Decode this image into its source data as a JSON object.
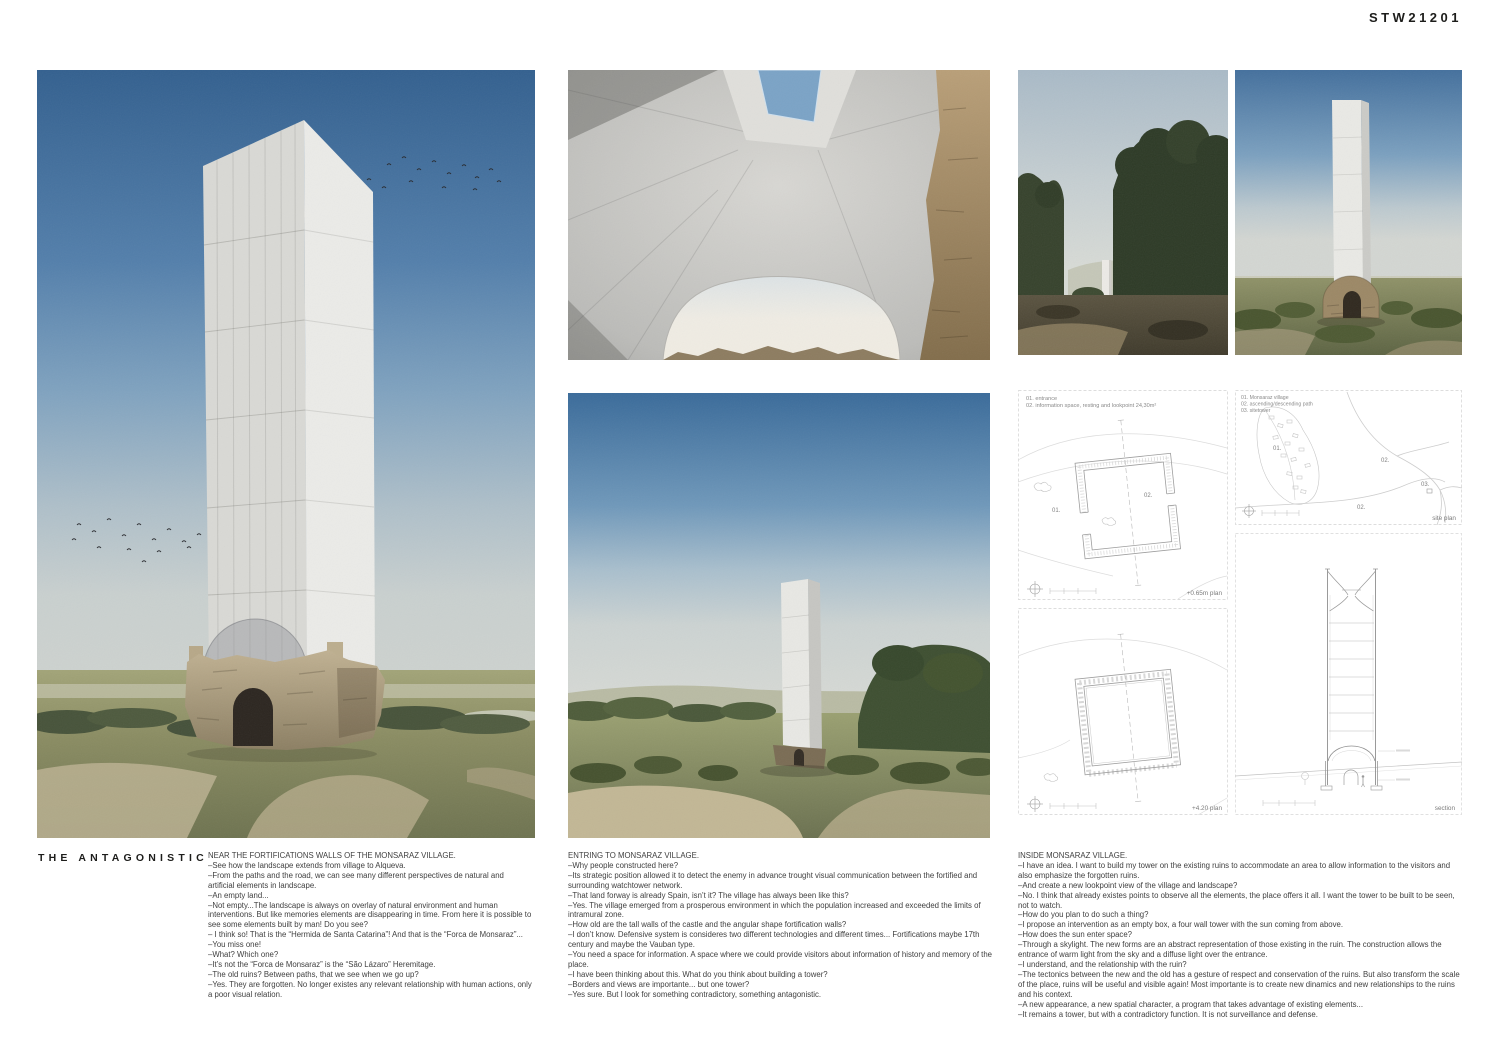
{
  "board": {
    "code": "STW21201",
    "title": "THE ANTAGONISTIC"
  },
  "colors": {
    "sky_deep": "#33608f",
    "sky_pale": "#ccd4d4",
    "concrete": "#e3e3e1",
    "ruin_stone": "#b3a387",
    "landscape_olive": "#6f7350",
    "drawing_line": "#9e9e9e"
  },
  "columns": [
    {
      "heading": "NEAR THE FORTIFICATIONS WALLS OF THE MONSARAZ VILLAGE.",
      "lines": [
        "–See how the landscape extends from village to Alqueva.",
        "–From the paths and the road, we can see many different perspectives de natural and artificial elements in landscape.",
        "–An empty land...",
        "–Not empty...The landscape is always on overlay of natural environment and human interventions. But like memories elements are disappearing in time. From here it is possible to see some elements built by man! Do you see?",
        "– I think so! That is the “Hermida de Santa Catarina”! And that is the “Forca de Monsaraz”...",
        "–You miss one!",
        "–What? Which one?",
        "–It’s not the “Forca de Monsaraz” is the “São Lázaro” Heremitage.",
        "–The old ruins? Between paths, that we see when we go up?",
        "–Yes. They are forgotten. No longer existes any relevant relationship with human actions, only a poor visual relation."
      ]
    },
    {
      "heading": "ENTRING TO MONSARAZ VILLAGE.",
      "lines": [
        "–Why people constructed here?",
        "–Its strategic position allowed it to detect the enemy in advance trought visual communication between the fortified and surrounding watchtower network.",
        "–That land forway is already Spain, isn’t it? The village has always been like this?",
        "–Yes. The village emerged from a prosperous environment in which the population increased and exceeded the limits of intramural zone.",
        "–How old are the tall walls of the castle and the angular shape fortification walls?",
        "–I don’t know. Defensive system is consideres two different technologies and different times... Fortifications maybe 17th century  and maybe the Vauban type.",
        "–You need a space for information. A space where we could provide visitors about information of history and memory of the place.",
        "–I have been thinking about this. What do you think about building a tower?",
        "–Borders and views are importante... but one tower?",
        "–Yes sure. But I look for something contradictory, something antagonistic."
      ]
    },
    {
      "heading": "INSIDE MONSARAZ VILLAGE.",
      "lines": [
        "–I have an idea. I want to build my tower on the existing ruins to accommodate an area to allow information to the visitors and also emphasize the forgotten ruins.",
        "–And create a new lookpoint view of the village and landscape?",
        "–No. I think that already existes points to observe all the elements, the place offers it all. I want the tower to be built to be seen, not to watch.",
        "–How do you plan to do such a thing?",
        "–I propose an intervention as an empty box, a four wall tower with the sun coming from above.",
        "–How does the sun enter space?",
        "–Through a skylight. The new forms are an abstract representation of those existing in the ruin. The construction allows the entrance of warm light from the sky and a diffuse light over the entrance.",
        "–I understand, and the relationship with the ruin?",
        "–The tectonics between the new and the old has a gesture of respect and conservation of the ruins. But also transform the scale of the place, ruins will be useful and visible again! Most importante is to create new dinamics and new relationships to the ruins and his context.",
        "–A new appearance, a new spatial character, a program that takes advantage of existing elements...",
        "–It remains a tower, but with a contradictory function. It is not surveillance and defense."
      ]
    }
  ],
  "drawings": {
    "plan065": {
      "legend1": "01. entrance",
      "legend2": "02. information space, resting and lookpoint 24,30m²",
      "label01": "01.",
      "label02": "02.",
      "caption": "+0.65m plan"
    },
    "siteplan": {
      "legend1": "01. Monsaraz village",
      "legend2": "02. ascending/descending path",
      "legend3": "03. sitetower",
      "label01": "01.",
      "label02a": "02.",
      "label02b": "02.",
      "label03": "03.",
      "caption": "site plan"
    },
    "plan420": {
      "caption": "+4.20 plan"
    },
    "section": {
      "caption": "section"
    }
  }
}
